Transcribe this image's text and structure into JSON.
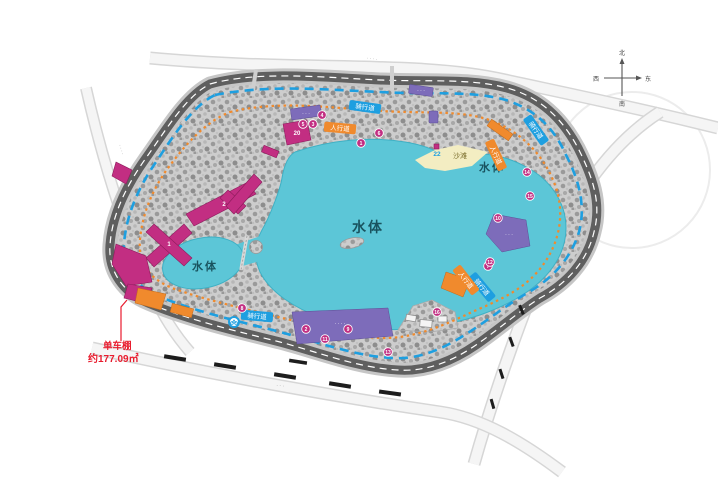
{
  "colors": {
    "lake": "#5cc6d7",
    "lake_edge": "#3fb0c4",
    "beach": "#f3edc2",
    "magenta": "#c22e82",
    "purple": "#7d6cba",
    "orange": "#f08a2d",
    "path_blue": "#1e9fe0",
    "ring_dark": "#5f5f5f",
    "ring_light": "#c6c6c6",
    "annotation_red": "#e81c2e",
    "water_text": "#19535f",
    "road_text": "#8a8a8a"
  },
  "water_labels": [
    {
      "text": "水体",
      "x": 368,
      "y": 232,
      "size": 14,
      "bold": true
    },
    {
      "text": "水体",
      "x": 492,
      "y": 171,
      "size": 11,
      "bold": true
    },
    {
      "text": "水体",
      "x": 205,
      "y": 270,
      "size": 11,
      "bold": true
    }
  ],
  "beach": {
    "label": "沙滩",
    "number": "22"
  },
  "paths": {
    "cycle_label": "骑行道",
    "walk_label": "人行道"
  },
  "path_labels": [
    {
      "type": "cycle",
      "x": 365,
      "y": 107,
      "rot": 8
    },
    {
      "type": "cycle",
      "x": 536,
      "y": 130,
      "rot": 55
    },
    {
      "type": "cycle",
      "x": 257,
      "y": 316,
      "rot": 5
    },
    {
      "type": "cycle",
      "x": 482,
      "y": 287,
      "rot": 50
    },
    {
      "type": "walk",
      "x": 340,
      "y": 128,
      "rot": 5
    },
    {
      "type": "walk",
      "x": 496,
      "y": 155,
      "rot": 65
    },
    {
      "type": "walk",
      "x": 466,
      "y": 280,
      "rot": 52
    }
  ],
  "badges": [
    {
      "n": "1",
      "x": 361,
      "y": 143
    },
    {
      "n": "6",
      "x": 379,
      "y": 133
    },
    {
      "n": "5",
      "x": 303,
      "y": 124
    },
    {
      "n": "3",
      "x": 313,
      "y": 124
    },
    {
      "n": "4",
      "x": 322,
      "y": 115
    },
    {
      "n": "7",
      "x": 488,
      "y": 266
    },
    {
      "n": "8",
      "x": 242,
      "y": 308
    },
    {
      "n": "9",
      "x": 348,
      "y": 329
    },
    {
      "n": "10",
      "x": 498,
      "y": 218
    },
    {
      "n": "11",
      "x": 325,
      "y": 339
    },
    {
      "n": "12",
      "x": 490,
      "y": 262
    },
    {
      "n": "13",
      "x": 388,
      "y": 352
    },
    {
      "n": "14",
      "x": 527,
      "y": 172
    },
    {
      "n": "15",
      "x": 530,
      "y": 196
    },
    {
      "n": "16",
      "x": 437,
      "y": 312
    },
    {
      "n": "2",
      "x": 306,
      "y": 329
    }
  ],
  "building_labels": [
    {
      "n": "1",
      "x": 169,
      "y": 246
    },
    {
      "n": "2",
      "x": 224,
      "y": 206
    },
    {
      "n": "20",
      "x": 297,
      "y": 135
    }
  ],
  "annotation": {
    "line1": "单车棚",
    "line2": "约177.09㎡"
  },
  "compass": {
    "n": "北",
    "s": "南",
    "w": "西",
    "e": "东"
  },
  "road_names": [
    {
      "text": "· · · ·",
      "x": 372,
      "y": 60,
      "rot": 7
    },
    {
      "text": "· · · ·",
      "x": 120,
      "y": 150,
      "rot": 72
    },
    {
      "text": "· · ·",
      "x": 280,
      "y": 387,
      "rot": 8
    }
  ],
  "zone_texts": [
    {
      "text": "· · · ·",
      "x": 340,
      "y": 325
    },
    {
      "text": "· · ·",
      "x": 509,
      "y": 236
    },
    {
      "text": "· · ·",
      "x": 306,
      "y": 115
    },
    {
      "text": "· · ·",
      "x": 421,
      "y": 92
    }
  ]
}
